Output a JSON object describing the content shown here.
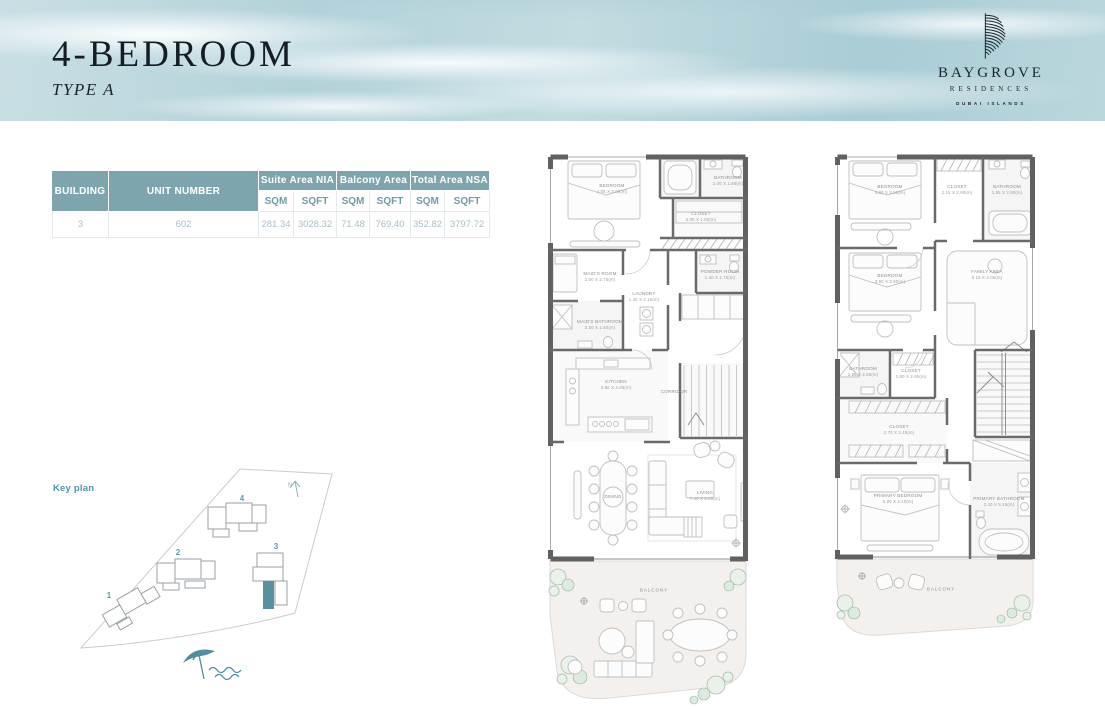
{
  "header": {
    "title": "4-BEDROOM",
    "subtitle": "TYPE A",
    "logo": {
      "brand": "BAYGROVE",
      "sub": "RESIDENCES",
      "location": "DUBAI ISLANDS"
    }
  },
  "area_table": {
    "col_building": "BUILDING",
    "col_unit_number": "UNIT NUMBER",
    "group_headers": [
      "Suite Area NIA",
      "Balcony Area",
      "Total Area NSA"
    ],
    "unit_headers": [
      "SQM",
      "SQFT",
      "SQM",
      "SQFT",
      "SQM",
      "SQFT"
    ],
    "row": {
      "building": "3",
      "unit_number": "602",
      "suite_sqm": "281.34",
      "suite_sqft": "3028.32",
      "balcony_sqm": "71.48",
      "balcony_sqft": "769.40",
      "total_sqm": "352.82",
      "total_sqft": "3797.72"
    }
  },
  "key_plan": {
    "label": "Key plan",
    "north_label": "N",
    "building_numbers": [
      "1",
      "2",
      "3",
      "4"
    ]
  },
  "floor_plans": [
    {
      "balcony_label": "BALCONY",
      "rooms": [
        {
          "label": "BEDROOM",
          "dims": "4.05 X 3.90(m)"
        },
        {
          "label": "BATHROOM",
          "dims": "2.00 X 1.85(m)"
        },
        {
          "label": "CLOSET",
          "dims": "2.00 X 1.80(m)"
        },
        {
          "label": "MAID'S ROOM",
          "dims": "2.00 X 2.75(m)"
        },
        {
          "label": "LAUNDRY",
          "dims": "1.40 X 2.10(m)"
        },
        {
          "label": "MAID'S BATHROOM",
          "dims": "2.50 X 1.50(m)"
        },
        {
          "label": "POWDER ROOM",
          "dims": "1.40 X 1.70(m)"
        },
        {
          "label": "KITCHEN",
          "dims": "3.80 X 4.05(m)"
        },
        {
          "label": "CORRIDOR",
          "dims": ""
        },
        {
          "label": "DINING",
          "dims": ""
        },
        {
          "label": "LIVING",
          "dims": "7.40 X 5.05(m)"
        }
      ]
    },
    {
      "balcony_label": "BALCONY",
      "rooms": [
        {
          "label": "BEDROOM",
          "dims": "3.60 X 3.90(m)"
        },
        {
          "label": "CLOSET",
          "dims": "2.15 X 2.90(m)"
        },
        {
          "label": "BATHROOM",
          "dims": "1.95 X 2.90(m)"
        },
        {
          "label": "BEDROOM",
          "dims": "3.60 X 3.90(m)"
        },
        {
          "label": "FAMILY AREA",
          "dims": "5.15 X 4.05(m)"
        },
        {
          "label": "BATHROOM",
          "dims": "1.85 X 2.85(m)"
        },
        {
          "label": "CLOSET",
          "dims": "1.80 X 2.90(m)"
        },
        {
          "label": "CLOSET",
          "dims": "3.70 X 2.45(m)"
        },
        {
          "label": "PRIMARY BEDROOM",
          "dims": "5.20 X 4.10(m)"
        },
        {
          "label": "PRIMARY BATHROOM",
          "dims": "2.40 X 5.15(m)"
        }
      ]
    }
  ],
  "colors": {
    "accent_teal": "#6f9ca6",
    "table_header_teal": "#7ea5ad",
    "highlighted_unit": "#57909f",
    "wall_gray": "#616161"
  }
}
